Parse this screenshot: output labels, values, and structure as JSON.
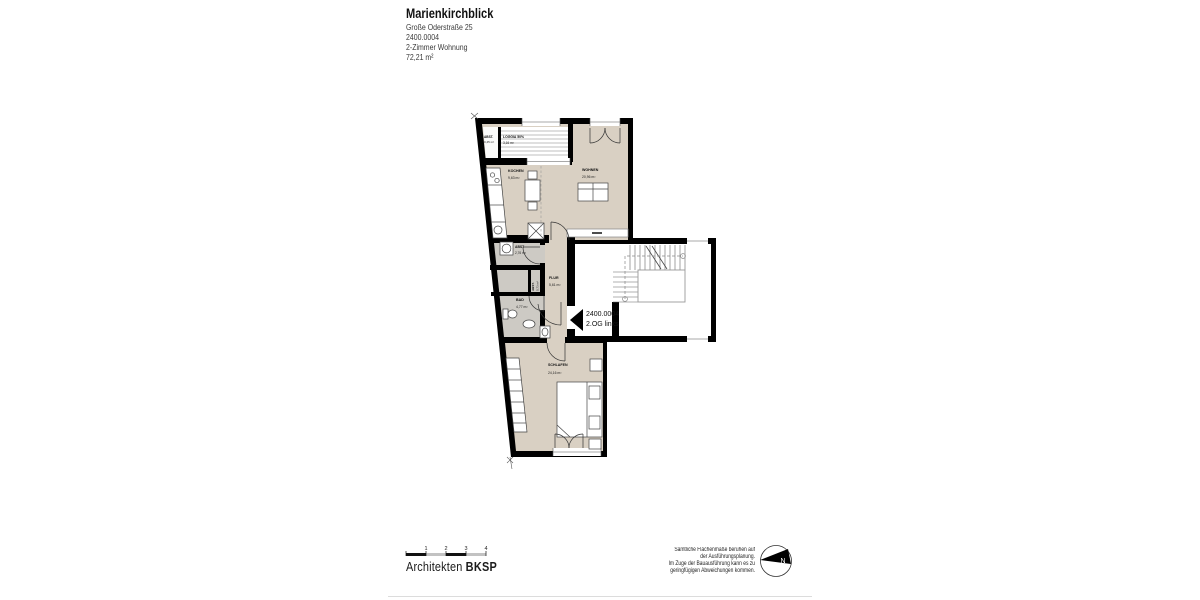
{
  "header": {
    "title": "Marienkirchblick",
    "address": "Große Oderstraße 25",
    "unit": "2400.0004",
    "type": "2-Zimmer Wohnung",
    "area": "72,21 m²"
  },
  "plan": {
    "rooms": {
      "abst_loggia": {
        "name": "ABST.",
        "area": "0,45 m²"
      },
      "loggia": {
        "name": "LOGGIA 50%",
        "area": "3,16 m²"
      },
      "kochen": {
        "name": "KOCHEN",
        "area": "9,63 m²"
      },
      "wohnen": {
        "name": "WOHNEN",
        "area": "20,96 m²"
      },
      "abst": {
        "name": "ABST",
        "area": "2,76 m²"
      },
      "abst_small": {
        "name": "ABST.",
        "area": "0,73 m²"
      },
      "flur": {
        "name": "FLUR",
        "area": "5,61 m²"
      },
      "bad": {
        "name": "BAD",
        "area": "4,77 m²"
      },
      "schlafen": {
        "name": "SCHLAFEN",
        "area": "24,16 m²"
      }
    },
    "unit_label": {
      "line1": "2400.0004",
      "line2": "2.OG links"
    }
  },
  "footer": {
    "scale_ticks": [
      "1",
      "2",
      "3",
      "4"
    ],
    "firm_regular": "Architekten",
    "firm_bold": "BKSP",
    "disclaimer": [
      "Sämtliche Flächenmaße beruhen auf",
      "der Ausführungsplanung.",
      "Im Zuge der Bauausführung kann es zu",
      "geringfügigen Abweichungen kommen."
    ],
    "north": "N"
  },
  "colors": {
    "wall": "#000000",
    "room_fill": "#d9d0c3",
    "service_fill": "#cdcac4",
    "stair_line": "#666666",
    "landing_line": "#999999"
  }
}
